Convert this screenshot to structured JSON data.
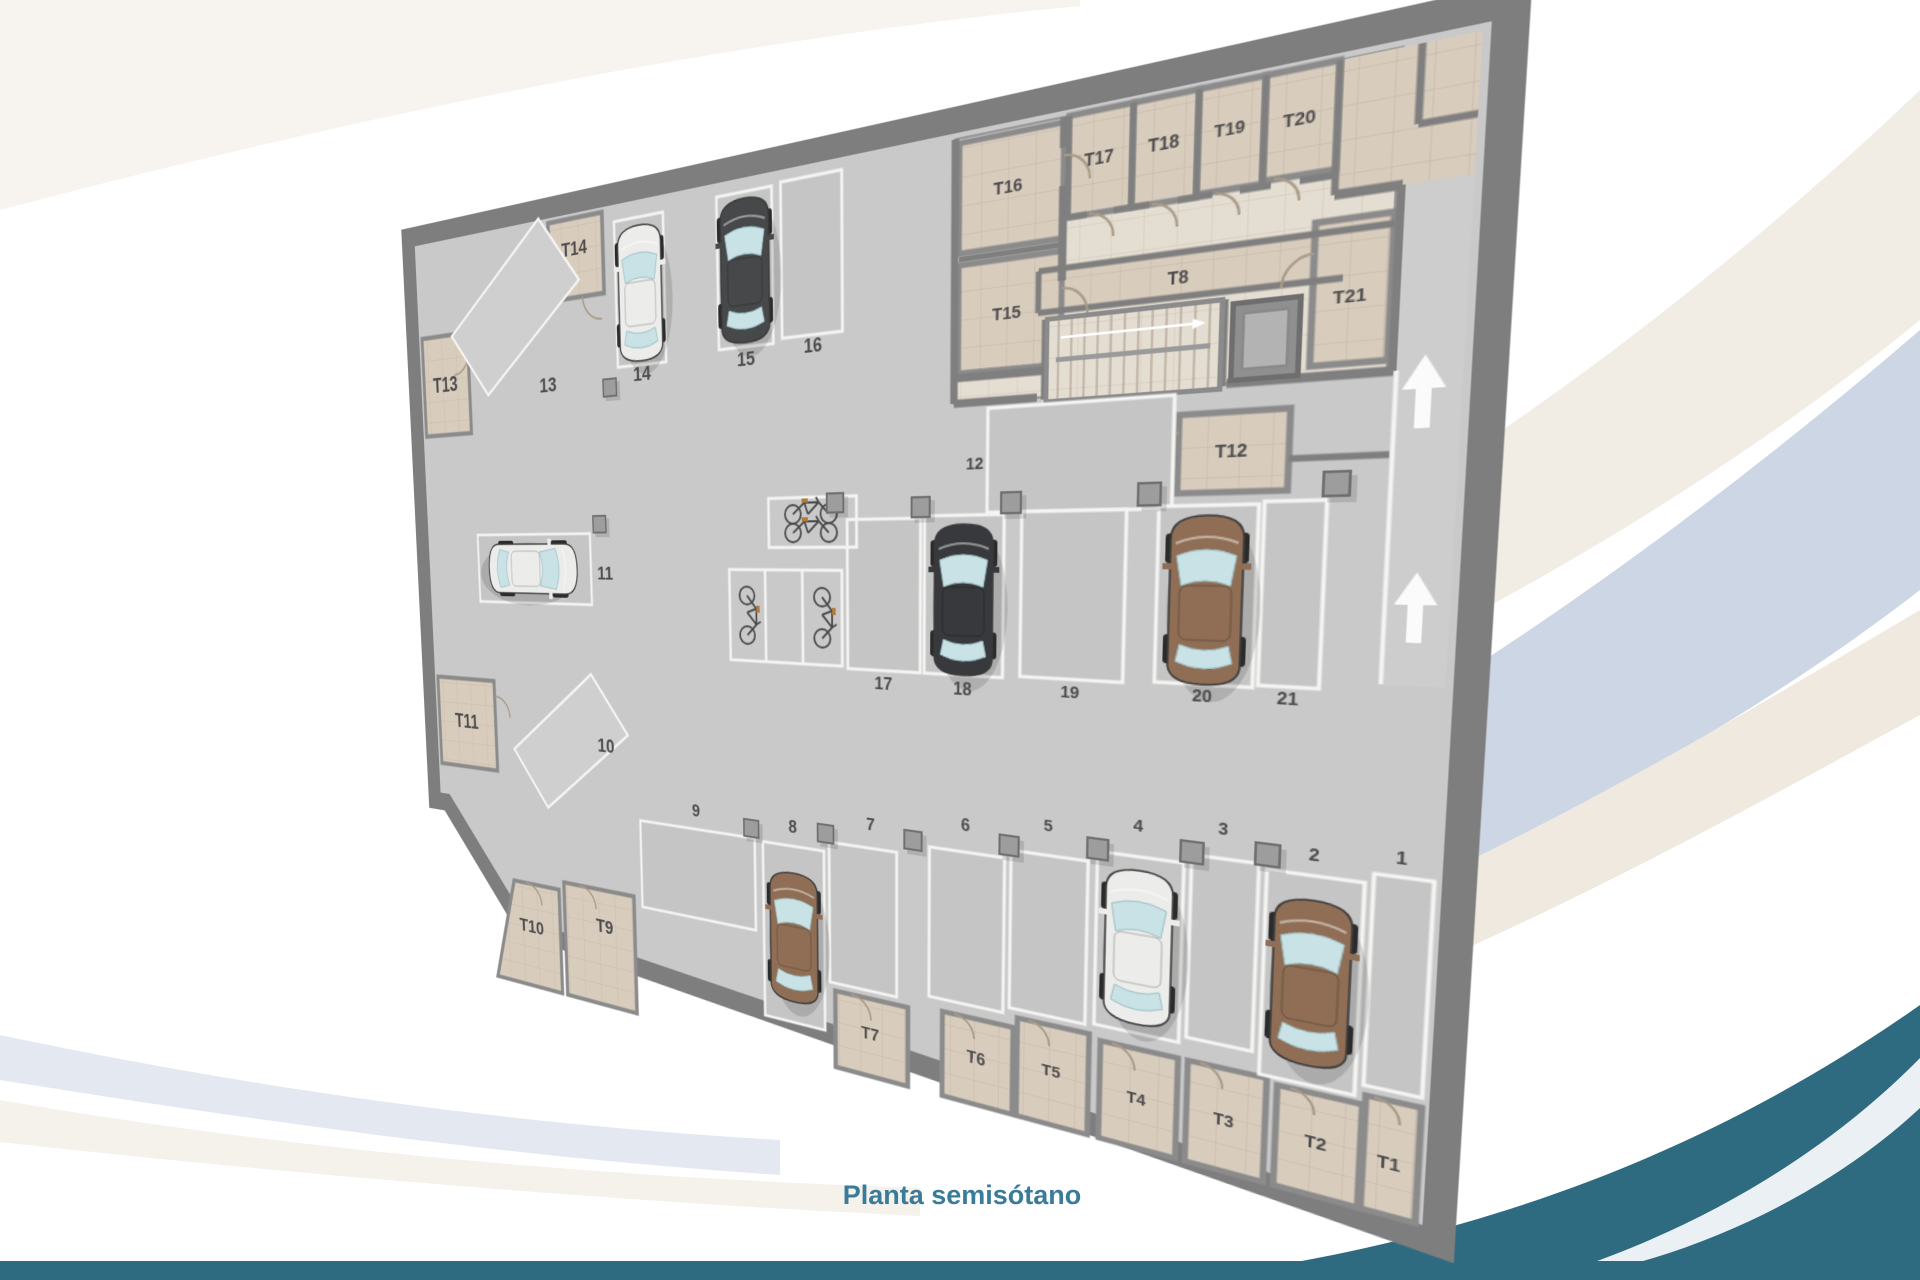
{
  "title": "Planta semisótano",
  "plan": {
    "storage_rooms": [
      "T1",
      "T2",
      "T3",
      "T4",
      "T5",
      "T6",
      "T7",
      "T8",
      "T9",
      "T10",
      "T11",
      "T12",
      "T13",
      "T14",
      "T15",
      "T16",
      "T17",
      "T18",
      "T19",
      "T20",
      "T21"
    ],
    "parking_spots": [
      "1",
      "2",
      "3",
      "4",
      "5",
      "6",
      "7",
      "8",
      "9",
      "10",
      "11",
      "12",
      "13",
      "14",
      "15",
      "16",
      "17",
      "18",
      "19",
      "20",
      "21"
    ],
    "cars": [
      {
        "spot": "2",
        "color": "brown"
      },
      {
        "spot": "4",
        "color": "white"
      },
      {
        "spot": "8",
        "color": "brown"
      },
      {
        "spot": "11",
        "color": "white"
      },
      {
        "spot": "14",
        "color": "white"
      },
      {
        "spot": "15",
        "color": "dark-gray"
      },
      {
        "spot": "18",
        "color": "black"
      },
      {
        "spot": "20",
        "color": "brown"
      }
    ],
    "bicycle_racks": 2,
    "ramp_arrows": {
      "count": 2,
      "direction": "up"
    },
    "facilities": [
      "stairs",
      "elevator"
    ],
    "icons": [
      "ramp-arrow-up-icon",
      "stairs-icon",
      "elevator-icon",
      "car-icon",
      "bicycle-icon"
    ]
  },
  "colors": {
    "accent_teal": "#2f6b80",
    "title_text": "#3a7b9a",
    "wall_gray": "#7e7e7e",
    "floor_gray": "#c9c9c9",
    "room_beige": "#d8ccbd",
    "band_cream": "#f1ede4",
    "band_blue": "#cdd6e4"
  }
}
